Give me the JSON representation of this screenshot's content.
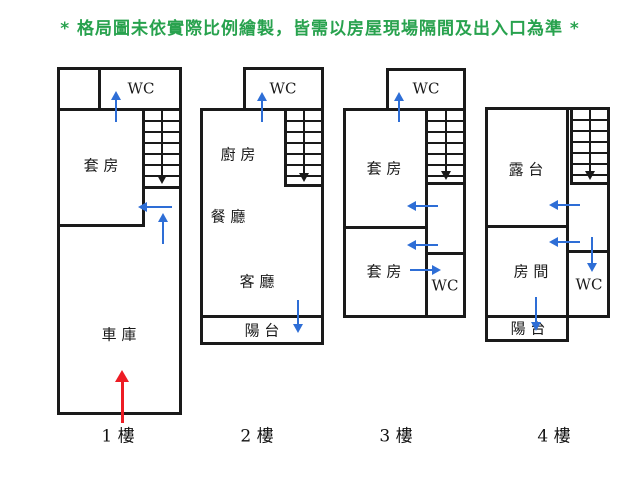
{
  "disclaimer": "* 格局圖未依實際比例繪製，皆需以房屋現場隔間及出入口為準 *",
  "colors": {
    "disclaimer_green": "#28a24e",
    "door_arrow_blue": "#2e6ed6",
    "entrance_arrow_red": "#ed1c24",
    "wall_black": "#1a1a1a"
  },
  "floors": [
    {
      "label": "1 樓",
      "rooms": {
        "wc": "WC",
        "suite": "套 房",
        "garage": "車 庫"
      }
    },
    {
      "label": "2 樓",
      "rooms": {
        "wc": "WC",
        "kitchen": "廚 房",
        "dining_room": "餐 廳",
        "living_room": "客 廳",
        "balcony": "陽 台"
      }
    },
    {
      "label": "3 樓",
      "rooms": {
        "wc_upper": "WC",
        "suite_upper": "套 房",
        "suite_lower": "套 房",
        "wc_lower": "WC"
      }
    },
    {
      "label": "4 樓",
      "rooms": {
        "terrace": "露 台",
        "bedroom": "房 間",
        "wc": "WC",
        "balcony": "陽 台"
      }
    }
  ]
}
